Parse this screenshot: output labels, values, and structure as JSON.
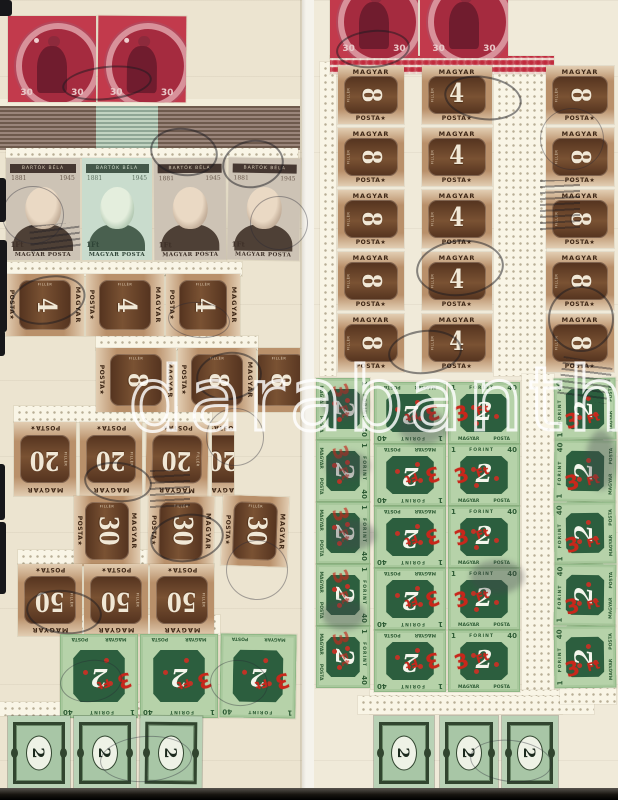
{
  "watermark": "darabanth",
  "palette": {
    "page_left": "#ece4d0",
    "page_right": "#f0ead9",
    "stamp_red": "#c23a4c",
    "stamp_brown": "#7a5233",
    "stamp_green": "#b6d2a9",
    "overprint_red": "#c8271b",
    "numeral_white": "#f1e8d6"
  },
  "stamps": {
    "red": {
      "value": "30"
    },
    "bartok": {
      "name": "BARTÓK BÉLA",
      "year_left": "1881",
      "year_right": "1945",
      "denomination": "1Ft",
      "footer": "MAGYAR POSTA"
    },
    "porto": {
      "header": "MAGYAR",
      "footer": "POSTA★",
      "side_label": "FILLÉR",
      "values": {
        "4": "4",
        "8": "8",
        "20": "20",
        "30": "30",
        "50": "50"
      }
    },
    "green": {
      "num_small": "1",
      "num_large": "40",
      "currency": "FORINT",
      "country": "MAGYAR",
      "service": "POSTA",
      "figure": "2",
      "overprint_value": "3",
      "overprint_unit": "Ft"
    },
    "small2": {
      "value": "2"
    }
  }
}
